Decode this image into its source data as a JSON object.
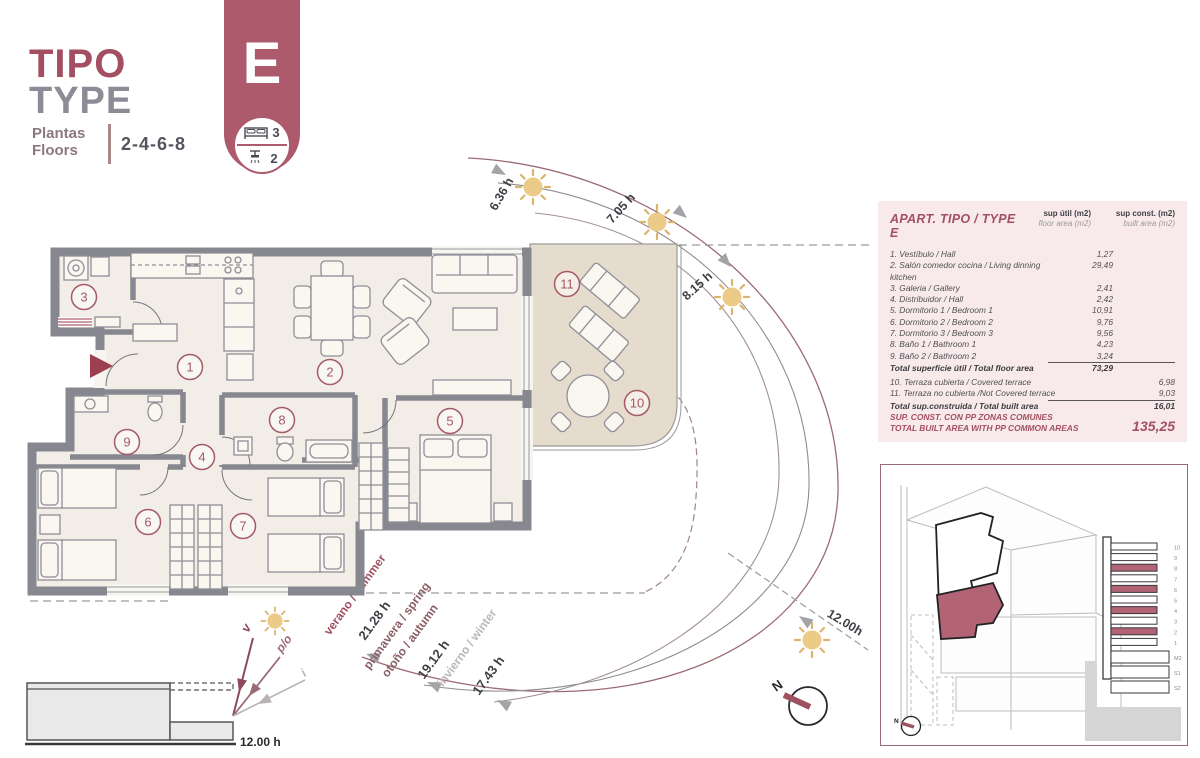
{
  "header": {
    "title_es": "TIPO",
    "title_en": "TYPE",
    "plantas_label": "Plantas",
    "floors_label": "Floors",
    "floor_numbers": "2-4-6-8"
  },
  "badge": {
    "letter": "E",
    "bed_count": "3",
    "shower_count": "2"
  },
  "plan": {
    "rooms": [
      "1",
      "2",
      "3",
      "4",
      "5",
      "6",
      "7",
      "8",
      "9",
      "10",
      "11"
    ]
  },
  "sun": {
    "sunrise_times": [
      "6.36 h",
      "7.05 h",
      "8.15 h"
    ],
    "noon_time": "12.00h",
    "seasons": {
      "summer_label": "verano / summer",
      "summer_hours": "21.28 h",
      "spring_label": "primavera / spring",
      "autumn_label": "otoño / autumn",
      "spring_autumn_hours": "19.12 h",
      "winter_label": "invierno / winter",
      "winter_hours": "17.43 h"
    }
  },
  "section_diagram": {
    "summer_abbr": "v",
    "spring_autumn_abbr": "p/o",
    "winter_abbr": "i",
    "time_label": "12.00 h"
  },
  "compass": {
    "north_label": "N"
  },
  "areas_table": {
    "title": "APART. TIPO / TYPE E",
    "col1_header": "sup útil (m2)",
    "col1_subheader": "floor area (m2)",
    "col2_header": "sup const. (m2)",
    "col2_subheader": "built area (m2)",
    "rows": [
      {
        "label": "1. Vestíbulo / Hall",
        "floor": "1,27"
      },
      {
        "label": "2. Salón comedor cocina / Living dinning kitchen",
        "floor": "29,49"
      },
      {
        "label": "3. Galeria / Gallery",
        "floor": "2,41"
      },
      {
        "label": "4. Distribuidor / Hall",
        "floor": "2,42"
      },
      {
        "label": "5. Dormitorio 1 / Bedroom 1",
        "floor": "10,91"
      },
      {
        "label": "6. Dormitorio 2 / Bedroom 2",
        "floor": "9,76"
      },
      {
        "label": "7. Dormitorio 3 / Bedroom 3",
        "floor": "9,56"
      },
      {
        "label": "8. Baño 1 / Bathroom 1",
        "floor": "4,23"
      },
      {
        "label": "9. Baño 2 / Bathroom 2",
        "floor": "3,24"
      }
    ],
    "total_floor": {
      "label": "Total superficie útil / Total floor area",
      "value": "73,29"
    },
    "terrace_rows": [
      {
        "label": "10. Terraza cubierta / Covered terrace",
        "built": "6,98"
      },
      {
        "label": "11. Terraza no cubierta /Not Covered terrace",
        "built": "9,03"
      }
    ],
    "total_built": {
      "label": "Total sup.construida / Total built area",
      "value": "16,01"
    },
    "footer": {
      "line1": "SUP. CONST. CON PP ZONAS COMUNES",
      "line2": "TOTAL BUILT AREA WITH PP COMMON AREAS",
      "value": "135,25"
    }
  },
  "site_box": {
    "floors": [
      "10",
      "9",
      "8",
      "7",
      "6",
      "5",
      "4",
      "3",
      "2",
      "1",
      "M2",
      "S1",
      "S2"
    ],
    "highlighted_floors": [
      "8",
      "6",
      "4",
      "2"
    ],
    "north_label": "N"
  }
}
